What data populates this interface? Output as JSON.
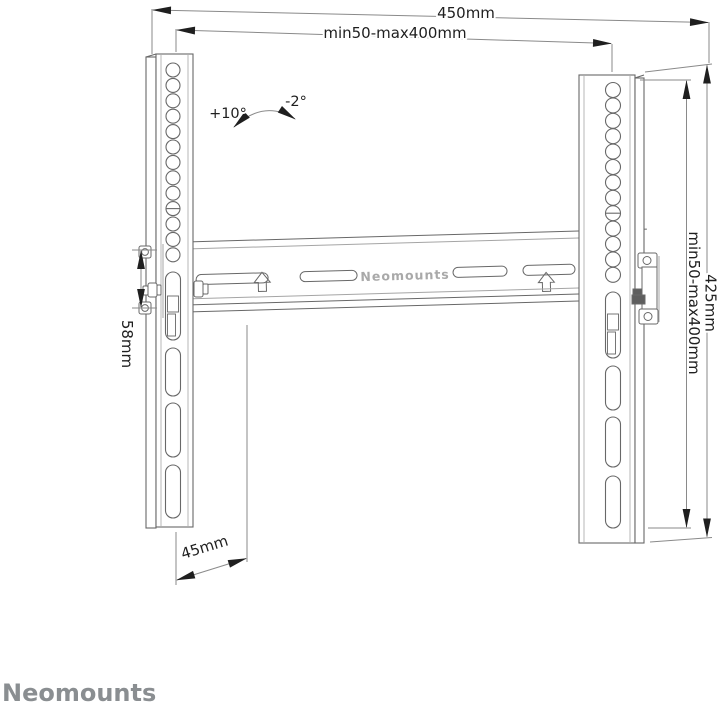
{
  "drawing": {
    "dimensions": {
      "total_width": "450mm",
      "vesa_width": "min50-max400mm",
      "tilt_up": "+10°",
      "tilt_down": "-2°",
      "bracket_height": "58mm",
      "vesa_height": "min50-max400mm",
      "total_height": "425mm",
      "depth": "45mm"
    },
    "plate_label": "Neomounts"
  },
  "footer": {
    "brand": "Neomounts"
  },
  "colors": {
    "dimension_line": "#8a8a8a",
    "dimension_text": "#1f1f1f",
    "arrowhead": "#1f1f1f",
    "structure": "#686868",
    "structure_light": "#a5a5a5",
    "clamp_dark": "#5e5e5e",
    "plate_text": "#a9a9a9",
    "brand": "#8a8e91"
  }
}
